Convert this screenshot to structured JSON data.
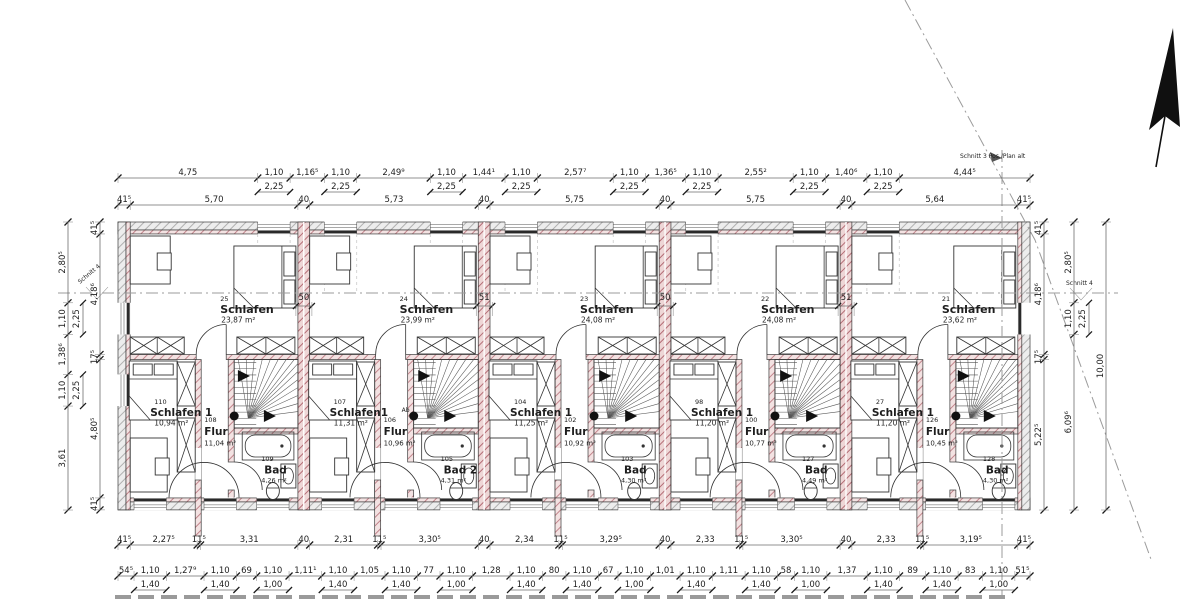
{
  "annotations": {
    "schnitt3": "Schnitt 3 Pos./Plan alt",
    "schnitt4_left": "Schnitt 4",
    "schnitt4_right": "Schnitt 4"
  },
  "colors": {
    "wall_hatch_gray_line": "#b0b0b0",
    "wall_hatch_gray_fill": "#ededed",
    "wall_hatch_pink_line": "#c2858c",
    "wall_hatch_pink_fill": "#f3e2e2",
    "party_wall_line": "#b46d76",
    "party_wall_fill": "#eed6d6",
    "ink": "#1e1e1e"
  },
  "dimensions": {
    "top_windows": [
      {
        "v": "4,75"
      },
      {
        "v": "1,10",
        "sub": "2,25"
      },
      {
        "v": "1,16⁵"
      },
      {
        "v": "1,10",
        "sub": "2,25"
      },
      {
        "v": "2,49⁹"
      },
      {
        "v": "1,10",
        "sub": "2,25"
      },
      {
        "v": "1,44¹"
      },
      {
        "v": "1,10",
        "sub": "2,25"
      },
      {
        "v": "2,57⁷"
      },
      {
        "v": "1,10",
        "sub": "2,25"
      },
      {
        "v": "1,36⁵"
      },
      {
        "v": "1,10",
        "sub": "2,25"
      },
      {
        "v": "2,55²"
      },
      {
        "v": "1,10",
        "sub": "2,25"
      },
      {
        "v": "1,40⁶"
      },
      {
        "v": "1,10",
        "sub": "2,25"
      },
      {
        "v": "4,44⁵"
      }
    ],
    "top_walls": [
      "41⁵",
      "5,70",
      "40",
      "5,73",
      "40",
      "5,75",
      "40",
      "5,75",
      "40",
      "5,64",
      "41⁵"
    ],
    "bottom_rooms": [
      "41⁵",
      "2,27⁵",
      "11⁵",
      "3,31",
      "40",
      "2,31",
      "11⁵",
      "3,30⁵",
      "40",
      "2,34",
      "11⁵",
      "3,29⁵",
      "40",
      "2,33",
      "11⁵",
      "3,30⁵",
      "40",
      "2,33",
      "11⁵",
      "3,19⁵",
      "41⁵"
    ],
    "bottom_windows": [
      {
        "v": "54⁵"
      },
      {
        "v": "1,10",
        "sub": "1,40"
      },
      {
        "v": "1,27⁹"
      },
      {
        "v": "1,10",
        "sub": "1,40"
      },
      {
        "v": "69"
      },
      {
        "v": "1,10",
        "sub": "1,00"
      },
      {
        "v": "1,11¹"
      },
      {
        "v": "1,10",
        "sub": "1,40"
      },
      {
        "v": "1,05"
      },
      {
        "v": "1,10",
        "sub": "1,40"
      },
      {
        "v": "77"
      },
      {
        "v": "1,10",
        "sub": "1,00"
      },
      {
        "v": "1,28"
      },
      {
        "v": "1,10",
        "sub": "1,40"
      },
      {
        "v": "80"
      },
      {
        "v": "1,10",
        "sub": "1,40"
      },
      {
        "v": "67"
      },
      {
        "v": "1,10",
        "sub": "1,00"
      },
      {
        "v": "1,01"
      },
      {
        "v": "1,10",
        "sub": "1,40"
      },
      {
        "v": "1,11"
      },
      {
        "v": "1,10",
        "sub": "1,40"
      },
      {
        "v": "58"
      },
      {
        "v": "1,10",
        "sub": "1,00"
      },
      {
        "v": "1,37"
      },
      {
        "v": "1,10",
        "sub": "1,40"
      },
      {
        "v": "89"
      },
      {
        "v": "1,10",
        "sub": "1,40"
      },
      {
        "v": "83"
      },
      {
        "v": "1,10",
        "sub": "1,00"
      },
      {
        "v": "51⁵"
      }
    ],
    "left_outer": [
      {
        "v": "2,80⁵"
      },
      {
        "v": "1,10",
        "sub": "2,25"
      },
      {
        "v": "1,38⁶"
      },
      {
        "v": "1,10",
        "sub": "2,25"
      },
      {
        "v": "3,61"
      }
    ],
    "left_inner": [
      "41⁵",
      "4,18⁶",
      "17⁵",
      "4,80⁵",
      "41⁵"
    ],
    "right_inner": [
      "41⁵",
      "4,18⁶",
      "17⁵",
      "5,22⁵"
    ],
    "right_mid": [
      {
        "v": "2,80⁵"
      },
      {
        "v": "1,10",
        "sub": "2,25"
      },
      {
        "v": "6,09⁶"
      }
    ],
    "right_total": [
      "10,00"
    ],
    "party_walls": [
      "50",
      "51",
      "50",
      "51"
    ]
  },
  "units": [
    {
      "schlafen": {
        "no": "25",
        "label": "Schlafen",
        "area": "23,87 m²"
      },
      "schlafen1": {
        "no": "110",
        "label": "Schlafen 1",
        "area": "10,94 m²"
      },
      "flur": {
        "no": "108",
        "label": "Flur",
        "area": "11,04 m²"
      },
      "bad": {
        "no": "109",
        "label": "Bad",
        "area": "4,26 m²"
      }
    },
    {
      "schlafen": {
        "no": "24",
        "label": "Schlafen",
        "area": "23,99 m²"
      },
      "schlafen1": {
        "no": "107",
        "label": "Schlafen1",
        "area": "11,31 m²"
      },
      "flur": {
        "no": "106",
        "label": "Flur",
        "area": "10,96 m²"
      },
      "bad": {
        "no": "105",
        "label": "Bad 2",
        "area": "4,31 m²"
      },
      "ab": "Ab"
    },
    {
      "schlafen": {
        "no": "23",
        "label": "Schlafen",
        "area": "24,08 m²"
      },
      "schlafen1": {
        "no": "104",
        "label": "Schlafen 1",
        "area": "11,25 m²"
      },
      "flur": {
        "no": "102",
        "label": "Flur",
        "area": "10,92 m²"
      },
      "bad": {
        "no": "103",
        "label": "Bad",
        "area": "4,30 m²"
      }
    },
    {
      "schlafen": {
        "no": "22",
        "label": "Schlafen",
        "area": "24,08 m²"
      },
      "schlafen1": {
        "no": "98",
        "label": "Schlafen 1",
        "area": "11,20 m²"
      },
      "flur": {
        "no": "100",
        "label": "Flur",
        "area": "10,77 m²"
      },
      "bad": {
        "no": "127",
        "label": "Bad",
        "area": "4,49 m²"
      }
    },
    {
      "schlafen": {
        "no": "21",
        "label": "Schlafen",
        "area": "23,62 m²"
      },
      "schlafen1": {
        "no": "27",
        "label": "Schlafen 1",
        "area": "11,20 m²"
      },
      "flur": {
        "no": "126",
        "label": "Flur",
        "area": "10,45 m²"
      },
      "bad": {
        "no": "128",
        "label": "Bad",
        "area": "4,30 m²"
      }
    }
  ]
}
